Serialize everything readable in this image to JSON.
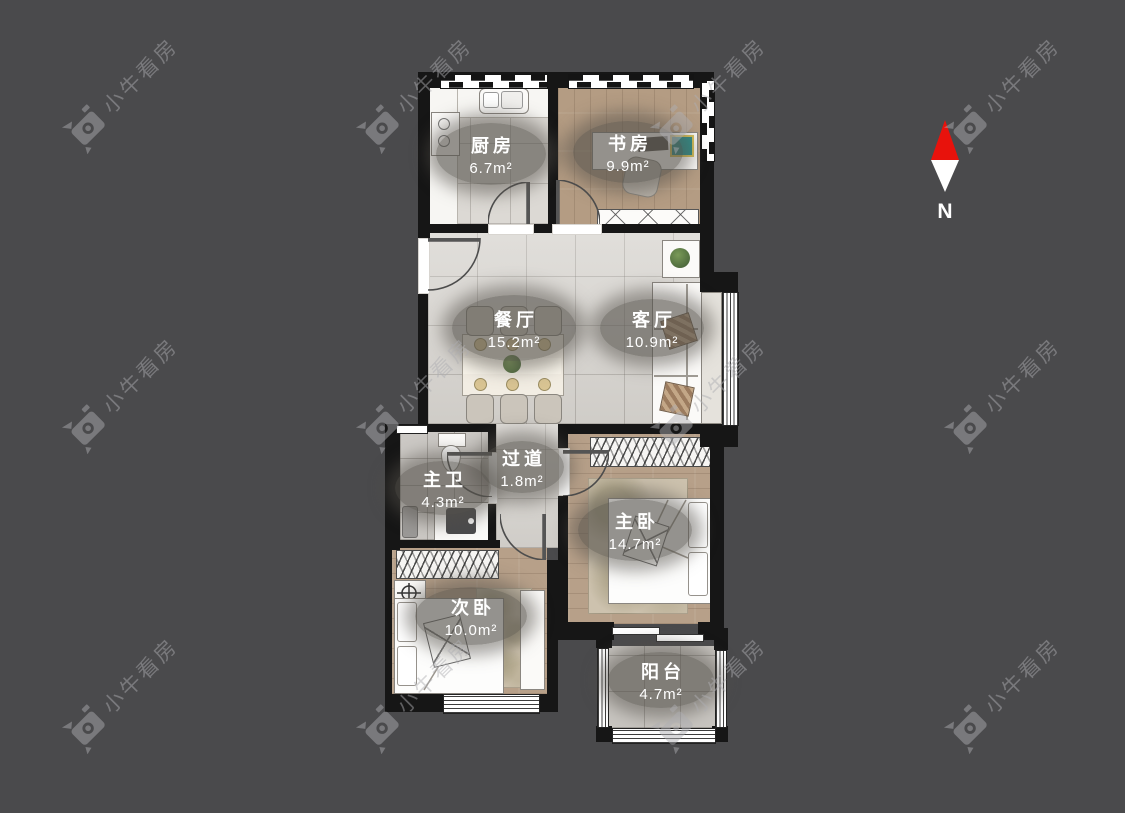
{
  "watermark": {
    "text": "小牛看房"
  },
  "compass": {
    "label": "N"
  },
  "colors": {
    "background": "#4a4a4c",
    "wall": "#161616",
    "compass_north": "#e8120c",
    "label_pill": "#54504a",
    "wood_floor": "#b7a089",
    "marble_floor": "#d8d5d0"
  },
  "rooms": [
    {
      "id": "kitchen",
      "name": "厨房",
      "area": "6.7m²"
    },
    {
      "id": "study",
      "name": "书房",
      "area": "9.9m²"
    },
    {
      "id": "dining",
      "name": "餐厅",
      "area": "15.2m²"
    },
    {
      "id": "living",
      "name": "客厅",
      "area": "10.9m²"
    },
    {
      "id": "master-bath",
      "name": "主卫",
      "area": "4.3m²"
    },
    {
      "id": "hallway",
      "name": "过道",
      "area": "1.8m²"
    },
    {
      "id": "master-bedroom",
      "name": "主卧",
      "area": "14.7m²"
    },
    {
      "id": "second-bedroom",
      "name": "次卧",
      "area": "10.0m²"
    },
    {
      "id": "balcony",
      "name": "阳台",
      "area": "4.7m²"
    }
  ]
}
